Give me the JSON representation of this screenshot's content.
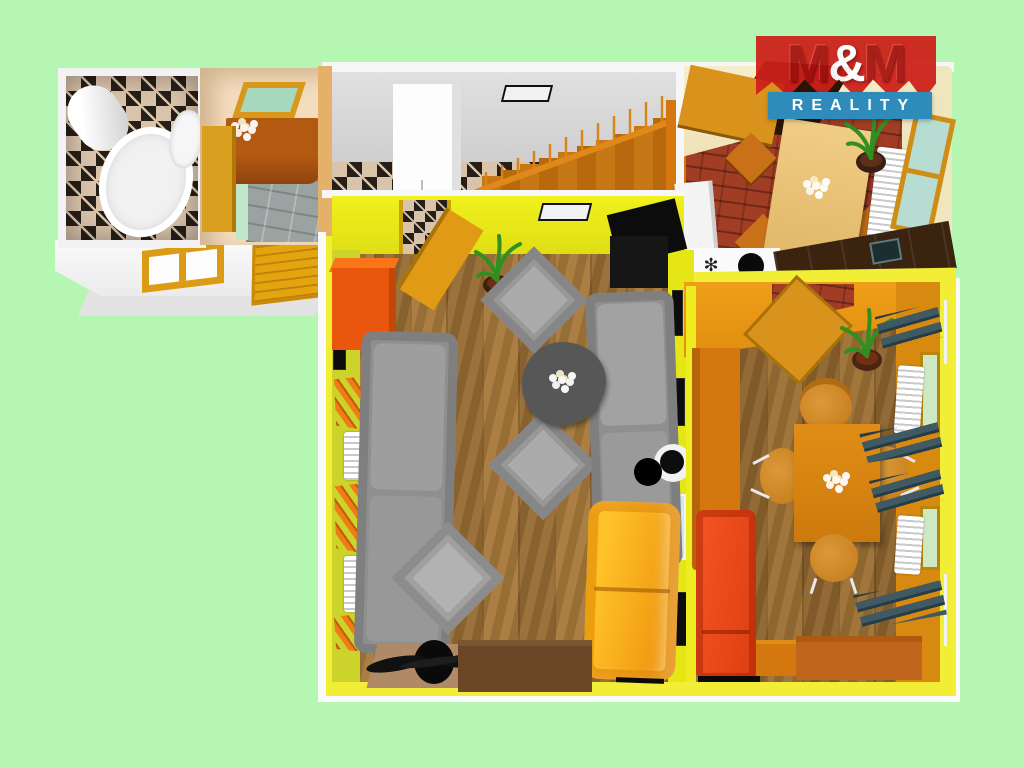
{
  "app": {
    "type": "3d-apartment-floor-plan-render",
    "description": "Isometric 3D floor plan of an apartment shown on a mint background"
  },
  "logo": {
    "m_left": "M",
    "ampersand": "&",
    "m_right": "M",
    "banner": "REALITY"
  },
  "palette": {
    "mint": "#b5f7b2",
    "outer_white": "#f8f8f8",
    "wall_gray": "#d6d6d6",
    "tile_base": "#d9c3ab",
    "tile_dark": "#261f18",
    "closet_wall": "#f4dcbe",
    "closet_chest": "#a8520f",
    "door_orange": "#dd9b1c",
    "stairs_orange": "#c27414",
    "lr_wall": "#eded1f",
    "lr_wall_left": "#ccd42b",
    "lr_floor": "#a87a3c",
    "sofa_gray": "#8f8f8f",
    "sofa_yellow": "#f6a81e",
    "wardrobe_orange": "#e9560e",
    "chest_brown": "#6a4526",
    "dr_wall": "#e59413",
    "dr_wall_dark": "#d8890f",
    "sofa_red": "#e8491c",
    "chest_amber": "#c0661c",
    "curtain_teal": "#3f5a63",
    "curtain_orange": "#f07c16",
    "kitchen_wall": "#f2e9c8",
    "kitchen_floor": "#a23d25",
    "cabinet_dark": "#3a2410",
    "table_beige": "#ecc57d",
    "table_amber": "#d9820f",
    "frame_yellow": "#f2ee35",
    "logo_red": "#ce201a",
    "logo_blue": "#2f8cba"
  },
  "rooms": [
    {
      "label": "bathroom",
      "items": [
        "water-heater",
        "bathtub",
        "toilet",
        "checker-tile-walls"
      ]
    },
    {
      "label": "entry-closet",
      "items": [
        "mirror",
        "brown-chest",
        "flowers",
        "door",
        "gray-tile-floor"
      ]
    },
    {
      "label": "hallway",
      "items": [
        "white-wardrobe",
        "wall-vent",
        "staircase-with-railing",
        "checker-tile-floor"
      ]
    },
    {
      "label": "kitchen",
      "items": [
        "open-door",
        "dining-table",
        "chairs",
        "potted-plant",
        "radiator",
        "window",
        "stove",
        "sink-cabinets",
        "brick-floor"
      ]
    },
    {
      "label": "living-room",
      "items": [
        "orange-wardrobe",
        "gray-sofa-left",
        "gray-sofa-right",
        "armchairs",
        "coffee-table",
        "flowers",
        "floor-lamp",
        "yellow-sofa",
        "brown-chest",
        "rug",
        "ceiling-fan",
        "tv",
        "potted-plant",
        "curtains",
        "radiators",
        "parquet-floor"
      ]
    },
    {
      "label": "dining-room",
      "items": [
        "open-door",
        "potted-plant",
        "tall-cabinet",
        "dining-table",
        "chairs",
        "flowers",
        "red-sofa",
        "side-table",
        "chest",
        "teal-curtains",
        "radiators",
        "windows",
        "parquet-floor"
      ]
    }
  ]
}
